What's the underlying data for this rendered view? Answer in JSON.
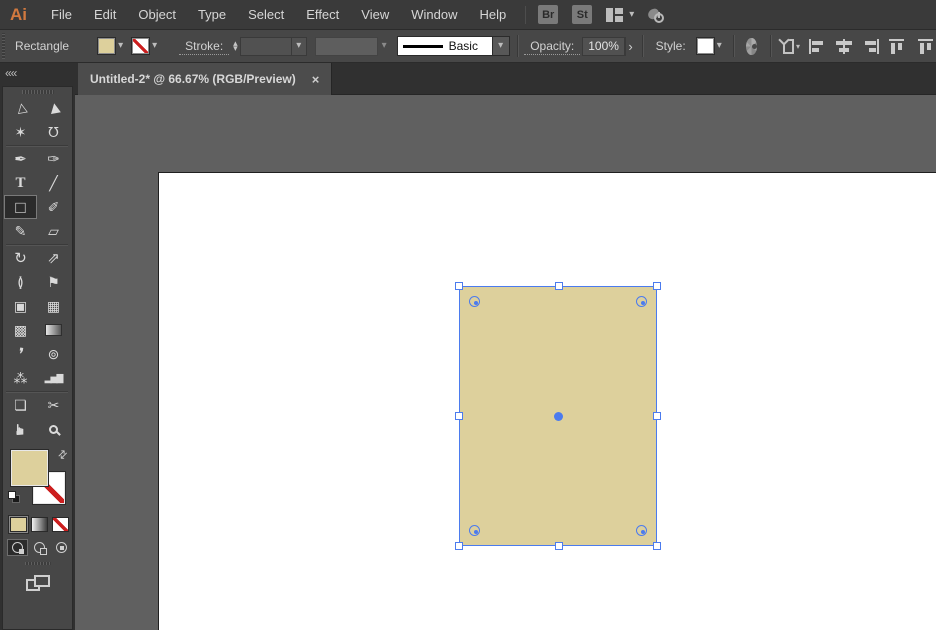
{
  "app": {
    "logo_text": "Ai"
  },
  "menubar": {
    "items": [
      {
        "label": "File"
      },
      {
        "label": "Edit"
      },
      {
        "label": "Object"
      },
      {
        "label": "Type"
      },
      {
        "label": "Select"
      },
      {
        "label": "Effect"
      },
      {
        "label": "View"
      },
      {
        "label": "Window"
      },
      {
        "label": "Help"
      }
    ],
    "bridge_label": "Br",
    "stock_label": "St",
    "workspace_chevron": "▾"
  },
  "controlbar": {
    "context_label": "Rectangle",
    "fill_chevron": "▾",
    "stroke_chevron": "▾",
    "stroke_label": "Stroke:",
    "stepper_up": "▴",
    "stepper_down": "▾",
    "stroke_width_chevron": "▾",
    "brush_chevron": "▾",
    "stroke_style_value": "Basic",
    "stroke_style_chevron": "▾",
    "opacity_label": "Opacity:",
    "opacity_value": "100%",
    "opacity_arrow": "›",
    "style_label": "Style:",
    "style_chevron": "▾",
    "shape_chevron": "▾"
  },
  "tabbar": {
    "active_tab": {
      "title": "Untitled-2* @ 66.67% (RGB/Preview)",
      "close_glyph": "×"
    }
  },
  "toolbar": {
    "collapse_glyph": "««",
    "active_tool": "rectangle-tool",
    "swap_glyph": "⇄",
    "tools": [
      {
        "name": "selection-tool",
        "glyph": "▷"
      },
      {
        "name": "direct-selection-tool",
        "glyph": "▶"
      },
      {
        "name": "magic-wand-tool",
        "glyph": "✶"
      },
      {
        "name": "lasso-tool",
        "glyph": "℧",
        "divider_after": true
      },
      {
        "name": "pen-tool",
        "glyph": "✒"
      },
      {
        "name": "curvature-tool",
        "glyph": "✑"
      },
      {
        "name": "type-tool",
        "glyph": "T"
      },
      {
        "name": "line-segment-tool",
        "glyph": "╱"
      },
      {
        "name": "rectangle-tool",
        "glyph": "□"
      },
      {
        "name": "paintbrush-tool",
        "glyph": "✐"
      },
      {
        "name": "shaper-tool",
        "glyph": "✎"
      },
      {
        "name": "eraser-tool",
        "glyph": "▱",
        "divider_after": true
      },
      {
        "name": "rotate-tool",
        "glyph": "↻"
      },
      {
        "name": "scale-tool",
        "glyph": "⇗"
      },
      {
        "name": "width-tool",
        "glyph": "≬"
      },
      {
        "name": "puppet-warp-tool",
        "glyph": "⚑"
      },
      {
        "name": "shape-builder-tool",
        "glyph": "▣"
      },
      {
        "name": "perspective-grid-tool",
        "glyph": "▦"
      },
      {
        "name": "mesh-tool",
        "glyph": "▩"
      },
      {
        "name": "gradient-tool",
        "glyph": ""
      },
      {
        "name": "eyedropper-tool",
        "glyph": "❜"
      },
      {
        "name": "blend-tool",
        "glyph": "⊚"
      },
      {
        "name": "symbol-sprayer-tool",
        "glyph": "⁂"
      },
      {
        "name": "column-graph-tool",
        "glyph": "▂▅▇",
        "divider_after": true
      },
      {
        "name": "artboard-tool",
        "glyph": "❏"
      },
      {
        "name": "slice-tool",
        "glyph": "✂"
      },
      {
        "name": "hand-tool",
        "glyph": "☛"
      },
      {
        "name": "zoom-tool",
        "glyph": ""
      }
    ]
  },
  "colors": {
    "object_fill": "#ddd09c",
    "selection_blue": "#4b7bee",
    "none_red": "#cc1f1f",
    "canvas_gray": "#606060",
    "panel_gray": "#474747"
  },
  "canvas": {
    "selected_object": {
      "type": "rectangle",
      "fill": "#ddd09c"
    }
  }
}
